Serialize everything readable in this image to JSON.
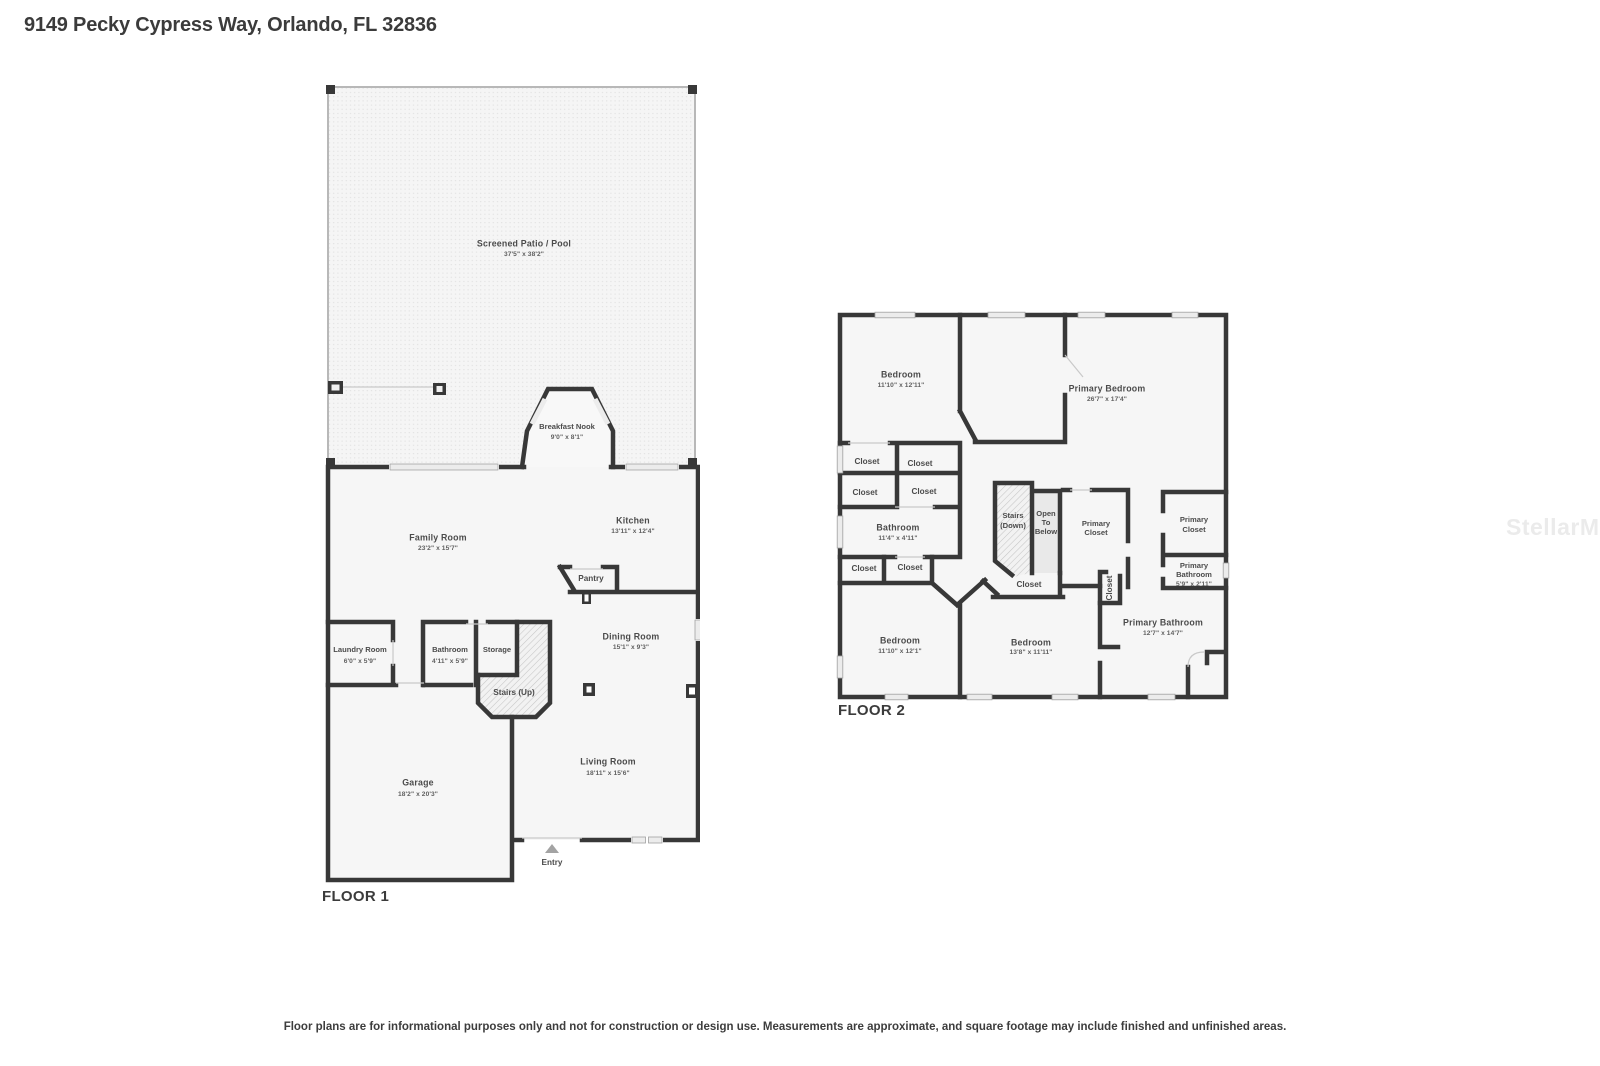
{
  "title": "9149 Pecky Cypress Way, Orlando, FL 32836",
  "watermark": "StellarMLS",
  "disclaimer": "Floor plans are for informational purposes only and not for construction or design use. Measurements are approximate, and square footage may include finished and unfinished areas.",
  "floor1": {
    "label": "FLOOR 1",
    "rooms": {
      "patio": {
        "name": "Screened Patio / Pool",
        "dims": "37'5\" x 38'2\""
      },
      "breakfast_nook": {
        "name": "Breakfast Nook",
        "dims": "9'0\" x 8'1\""
      },
      "family_room": {
        "name": "Family Room",
        "dims": "23'2\" x 15'7\""
      },
      "kitchen": {
        "name": "Kitchen",
        "dims": "13'11\" x 12'4\""
      },
      "pantry": {
        "name": "Pantry"
      },
      "dining_room": {
        "name": "Dining Room",
        "dims": "15'1\" x 9'3\""
      },
      "laundry_room": {
        "name": "Laundry Room",
        "dims": "6'0\" x 5'9\""
      },
      "bathroom": {
        "name": "Bathroom",
        "dims": "4'11\" x 5'9\""
      },
      "storage": {
        "name": "Storage"
      },
      "stairs_up": {
        "name": "Stairs (Up)"
      },
      "garage": {
        "name": "Garage",
        "dims": "18'2\" x 20'3\""
      },
      "living_room": {
        "name": "Living Room",
        "dims": "18'11\" x 15'6\""
      },
      "entry": {
        "name": "Entry"
      }
    }
  },
  "floor2": {
    "label": "FLOOR 2",
    "rooms": {
      "bedroom_tl": {
        "name": "Bedroom",
        "dims": "11'10\" x 12'11\""
      },
      "primary_bedroom": {
        "name": "Primary Bedroom",
        "dims": "26'7\" x 17'4\""
      },
      "closet_1": {
        "name": "Closet"
      },
      "closet_2": {
        "name": "Closet"
      },
      "closet_3": {
        "name": "Closet"
      },
      "closet_4": {
        "name": "Closet"
      },
      "bathroom": {
        "name": "Bathroom",
        "dims": "11'4\" x 4'11\""
      },
      "closet_5": {
        "name": "Closet"
      },
      "closet_6": {
        "name": "Closet"
      },
      "stairs_down": {
        "lines": [
          "Stairs",
          "(Down)"
        ]
      },
      "open_to_below": {
        "lines": [
          "Open",
          "To",
          "Below"
        ]
      },
      "primary_closet_center": {
        "lines": [
          "Primary",
          "Closet"
        ]
      },
      "closet_hall": {
        "name": "Closet"
      },
      "closet_vertical": {
        "name": "Closet"
      },
      "primary_closet_right": {
        "lines": [
          "Primary",
          "Closet"
        ]
      },
      "primary_bathroom_small": {
        "lines": [
          "Primary",
          "Bathroom"
        ],
        "dims": "5'9\" x 2'11\""
      },
      "primary_bathroom": {
        "name": "Primary Bathroom",
        "dims": "12'7\" x 14'7\""
      },
      "bedroom_bl": {
        "name": "Bedroom",
        "dims": "11'10\" x 12'1\""
      },
      "bedroom_bc": {
        "name": "Bedroom",
        "dims": "13'8\" x 11'11\""
      }
    }
  }
}
